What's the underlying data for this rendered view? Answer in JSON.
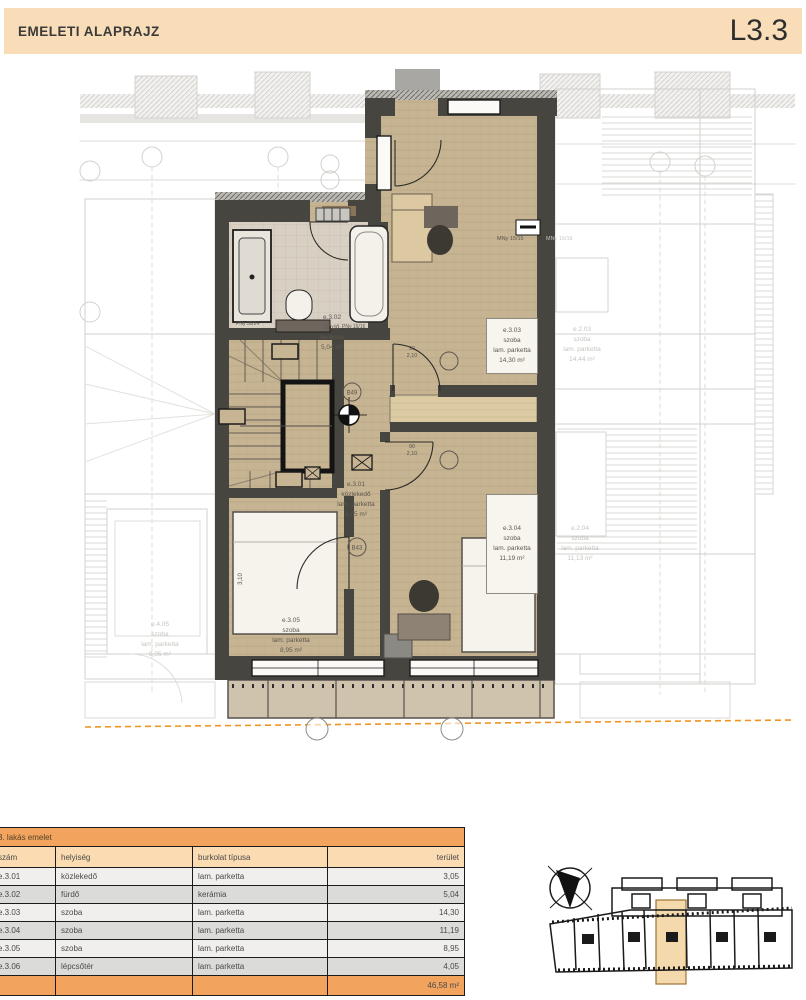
{
  "header": {
    "title": "EMELETI ALAPRAJZ",
    "code": "L3.3"
  },
  "plan": {
    "rooms": {
      "r301": {
        "id": "e.3.01",
        "name": "közlekedő",
        "floor": "lam. parketta",
        "area": "3,05 m²"
      },
      "r302": {
        "id": "e.3.02",
        "name": "fürdő",
        "floor": "kerámia",
        "area": "5,04 m²"
      },
      "r303": {
        "id": "e.3.03",
        "name": "szoba",
        "floor": "lam. parketta",
        "area": "14,30 m²"
      },
      "r304": {
        "id": "e.3.04",
        "name": "szoba",
        "floor": "lam. parketta",
        "area": "11,19 m²"
      },
      "r305": {
        "id": "e.3.05",
        "name": "szoba",
        "floor": "lam. parketta",
        "area": "8,95 m²"
      }
    },
    "neighbors": {
      "r203": {
        "id": "e.2.03",
        "name": "szoba",
        "floor": "lam. parketta",
        "area": "14,44 m²"
      },
      "r204": {
        "id": "e.2.04",
        "name": "szoba",
        "floor": "lam. parketta",
        "area": "11,13 m²"
      },
      "r405": {
        "id": "e.4.05",
        "name": "szoba",
        "floor": "lam. parketta",
        "area": "8,95 m²"
      }
    },
    "annotations": {
      "window1": "MNy 15/15",
      "window2": "MNy 16/16",
      "sill1": "PNy 30/24",
      "sill2": "PNy 16/16",
      "tag1": "B49",
      "tag2": "B43",
      "door_w": "90",
      "door_h": "2,10",
      "dim1": "3,10"
    }
  },
  "table": {
    "title": "3. lakás emelet",
    "columns": [
      "szám",
      "helyiség",
      "burkolat típusa",
      "terület"
    ],
    "rows": [
      {
        "id": "e.3.01",
        "name": "közlekedő",
        "floor": "lam. parketta",
        "area": "3,05"
      },
      {
        "id": "e.3.02",
        "name": "fürdő",
        "floor": "kerámia",
        "area": "5,04"
      },
      {
        "id": "e.3.03",
        "name": "szoba",
        "floor": "lam. parketta",
        "area": "14,30"
      },
      {
        "id": "e.3.04",
        "name": "szoba",
        "floor": "lam. parketta",
        "area": "11,19"
      },
      {
        "id": "e.3.05",
        "name": "szoba",
        "floor": "lam. parketta",
        "area": "8,95"
      },
      {
        "id": "e.3.06",
        "name": "lépcsőtér",
        "floor": "lam. parketta",
        "area": "4,05"
      }
    ],
    "total": "46,58 m²"
  },
  "colors": {
    "header_bg": "#f8ddb8",
    "wall": "#474540",
    "floor": "#c6b493",
    "accent_line": "#f09422",
    "table_orange": "#f2a45f"
  }
}
